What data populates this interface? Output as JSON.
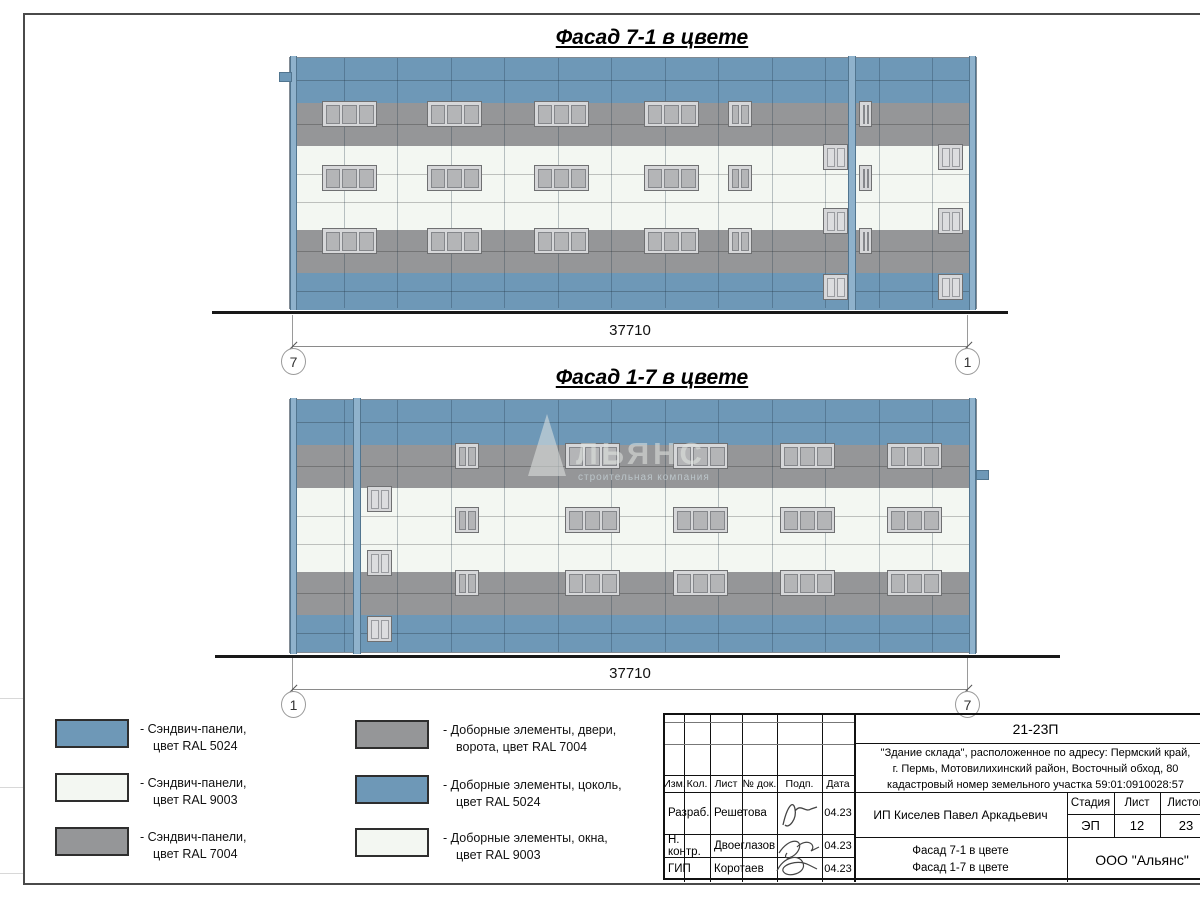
{
  "colors": {
    "ral5024": "#6e98b7",
    "ral9003": "#f3f7f2",
    "ral7004": "#959698"
  },
  "facade_geometry": {
    "width": 686,
    "height": 252,
    "bands": [
      {
        "y": 0,
        "h": 45,
        "color": "ral5024",
        "joints": [
          22
        ]
      },
      {
        "y": 45,
        "h": 43,
        "color": "ral7004",
        "joints": [
          21
        ]
      },
      {
        "y": 88,
        "h": 84,
        "color": "ral9003",
        "joints": [
          28,
          56
        ]
      },
      {
        "y": 172,
        "h": 43,
        "color": "ral7004",
        "joints": [
          21
        ]
      },
      {
        "y": 215,
        "h": 37,
        "color": "ral5024",
        "joints": [
          18
        ]
      }
    ],
    "vjoint_spacing": 53.5
  },
  "facade1": {
    "title": "Фасад 7-1 в цвете",
    "dimension": "37710",
    "axis_left": "7",
    "axis_right": "1",
    "pilasters": [
      [
        0,
        7
      ],
      [
        558,
        8
      ],
      [
        679,
        7
      ]
    ],
    "tab": [
      -11,
      14,
      11,
      8
    ],
    "windows": [
      [
        32,
        43,
        55,
        26,
        3,
        0
      ],
      [
        137,
        43,
        55,
        26,
        3,
        0
      ],
      [
        244,
        43,
        55,
        26,
        3,
        0
      ],
      [
        354,
        43,
        55,
        26,
        3,
        0
      ],
      [
        32,
        107,
        55,
        26,
        3,
        0
      ],
      [
        137,
        107,
        55,
        26,
        3,
        0
      ],
      [
        244,
        107,
        55,
        26,
        3,
        0
      ],
      [
        354,
        107,
        55,
        26,
        3,
        0
      ],
      [
        32,
        170,
        55,
        26,
        3,
        0
      ],
      [
        137,
        170,
        55,
        26,
        3,
        0
      ],
      [
        244,
        170,
        55,
        26,
        3,
        0
      ],
      [
        354,
        170,
        55,
        26,
        3,
        0
      ],
      [
        438,
        43,
        24,
        26,
        2,
        0
      ],
      [
        438,
        107,
        24,
        26,
        2,
        0
      ],
      [
        438,
        170,
        24,
        26,
        2,
        0
      ],
      [
        569,
        43,
        13,
        26,
        2,
        0
      ],
      [
        569,
        107,
        13,
        26,
        2,
        0
      ],
      [
        569,
        170,
        13,
        26,
        2,
        0
      ],
      [
        533,
        86,
        25,
        26,
        2,
        1
      ],
      [
        533,
        150,
        25,
        26,
        2,
        1
      ],
      [
        533,
        216,
        25,
        26,
        2,
        1
      ],
      [
        648,
        86,
        25,
        26,
        2,
        1
      ],
      [
        648,
        150,
        25,
        26,
        2,
        1
      ],
      [
        648,
        216,
        25,
        26,
        2,
        1
      ]
    ]
  },
  "facade2": {
    "title": "Фасад 1-7 в цвете",
    "dimension": "37710",
    "axis_left": "1",
    "axis_right": "7",
    "pilasters": [
      [
        0,
        7
      ],
      [
        63,
        8
      ],
      [
        679,
        7
      ]
    ],
    "tab": [
      686,
      70,
      11,
      8
    ],
    "windows": [
      [
        77,
        86,
        25,
        26,
        2,
        1
      ],
      [
        77,
        150,
        25,
        26,
        2,
        1
      ],
      [
        77,
        216,
        25,
        26,
        2,
        1
      ],
      [
        165,
        43,
        24,
        26,
        2,
        0
      ],
      [
        165,
        107,
        24,
        26,
        2,
        0
      ],
      [
        165,
        170,
        24,
        26,
        2,
        0
      ],
      [
        275,
        43,
        55,
        26,
        3,
        0
      ],
      [
        383,
        43,
        55,
        26,
        3,
        0
      ],
      [
        490,
        43,
        55,
        26,
        3,
        0
      ],
      [
        597,
        43,
        55,
        26,
        3,
        0
      ],
      [
        275,
        107,
        55,
        26,
        3,
        0
      ],
      [
        383,
        107,
        55,
        26,
        3,
        0
      ],
      [
        490,
        107,
        55,
        26,
        3,
        0
      ],
      [
        597,
        107,
        55,
        26,
        3,
        0
      ],
      [
        275,
        170,
        55,
        26,
        3,
        0
      ],
      [
        383,
        170,
        55,
        26,
        3,
        0
      ],
      [
        490,
        170,
        55,
        26,
        3,
        0
      ],
      [
        597,
        170,
        55,
        26,
        3,
        0
      ]
    ]
  },
  "watermark": {
    "word": "ЛЬЯНС",
    "subtitle": "строительная компания"
  },
  "legend": {
    "items": [
      {
        "color": "ral5024",
        "line1": "- Сэндвич-панели,",
        "line2": "цвет RAL 5024"
      },
      {
        "color": "ral9003",
        "line1": "- Сэндвич-панели,",
        "line2": "цвет RAL 9003"
      },
      {
        "color": "ral7004",
        "line1": "- Сэндвич-панели,",
        "line2": "цвет RAL 7004"
      },
      {
        "color": "ral7004",
        "line1": "- Доборные элементы, двери,",
        "line2": "ворота, цвет RAL 7004"
      },
      {
        "color": "ral5024",
        "line1": "- Доборные элементы, цоколь,",
        "line2": "цвет RAL 5024"
      },
      {
        "color": "ral9003",
        "line1": "- Доборные элементы, окна,",
        "line2": "цвет RAL 9003"
      }
    ]
  },
  "titleblock": {
    "doc_number": "21-23П",
    "address_line1": "\"Здание склада\", расположенное по адресу: Пермский край,",
    "address_line2": "г. Пермь, Мотовилихинский район, Восточный обход, 80",
    "address_line3": "кадастровый номер земельного участка 59:01:0910028:57",
    "col_izm": "Изм.",
    "col_kol": "Кол.",
    "col_list": "Лист",
    "col_ndok": "№ док.",
    "col_podp": "Подп.",
    "col_data": "Дата",
    "row1_role": "Разраб.",
    "row1_name": "Решетова",
    "row1_date": "04.23",
    "row2_role": "Н. контр.",
    "row2_name": "Двоеглазов",
    "row2_date": "04.23",
    "row3_role": "ГИП",
    "row3_name": "Коротаев",
    "row3_date": "04.23",
    "client": "ИП Киселев Павел Аркадьевич",
    "sheet_title_line1": "Фасад 7-1 в цвете",
    "sheet_title_line2": "Фасад 1-7 в цвете",
    "stage_label": "Стадия",
    "sheet_label": "Лист",
    "sheets_label": "Листов",
    "stage_value": "ЭП",
    "sheet_value": "12",
    "sheets_value": "23",
    "company": "ООО \"Альянс\""
  }
}
